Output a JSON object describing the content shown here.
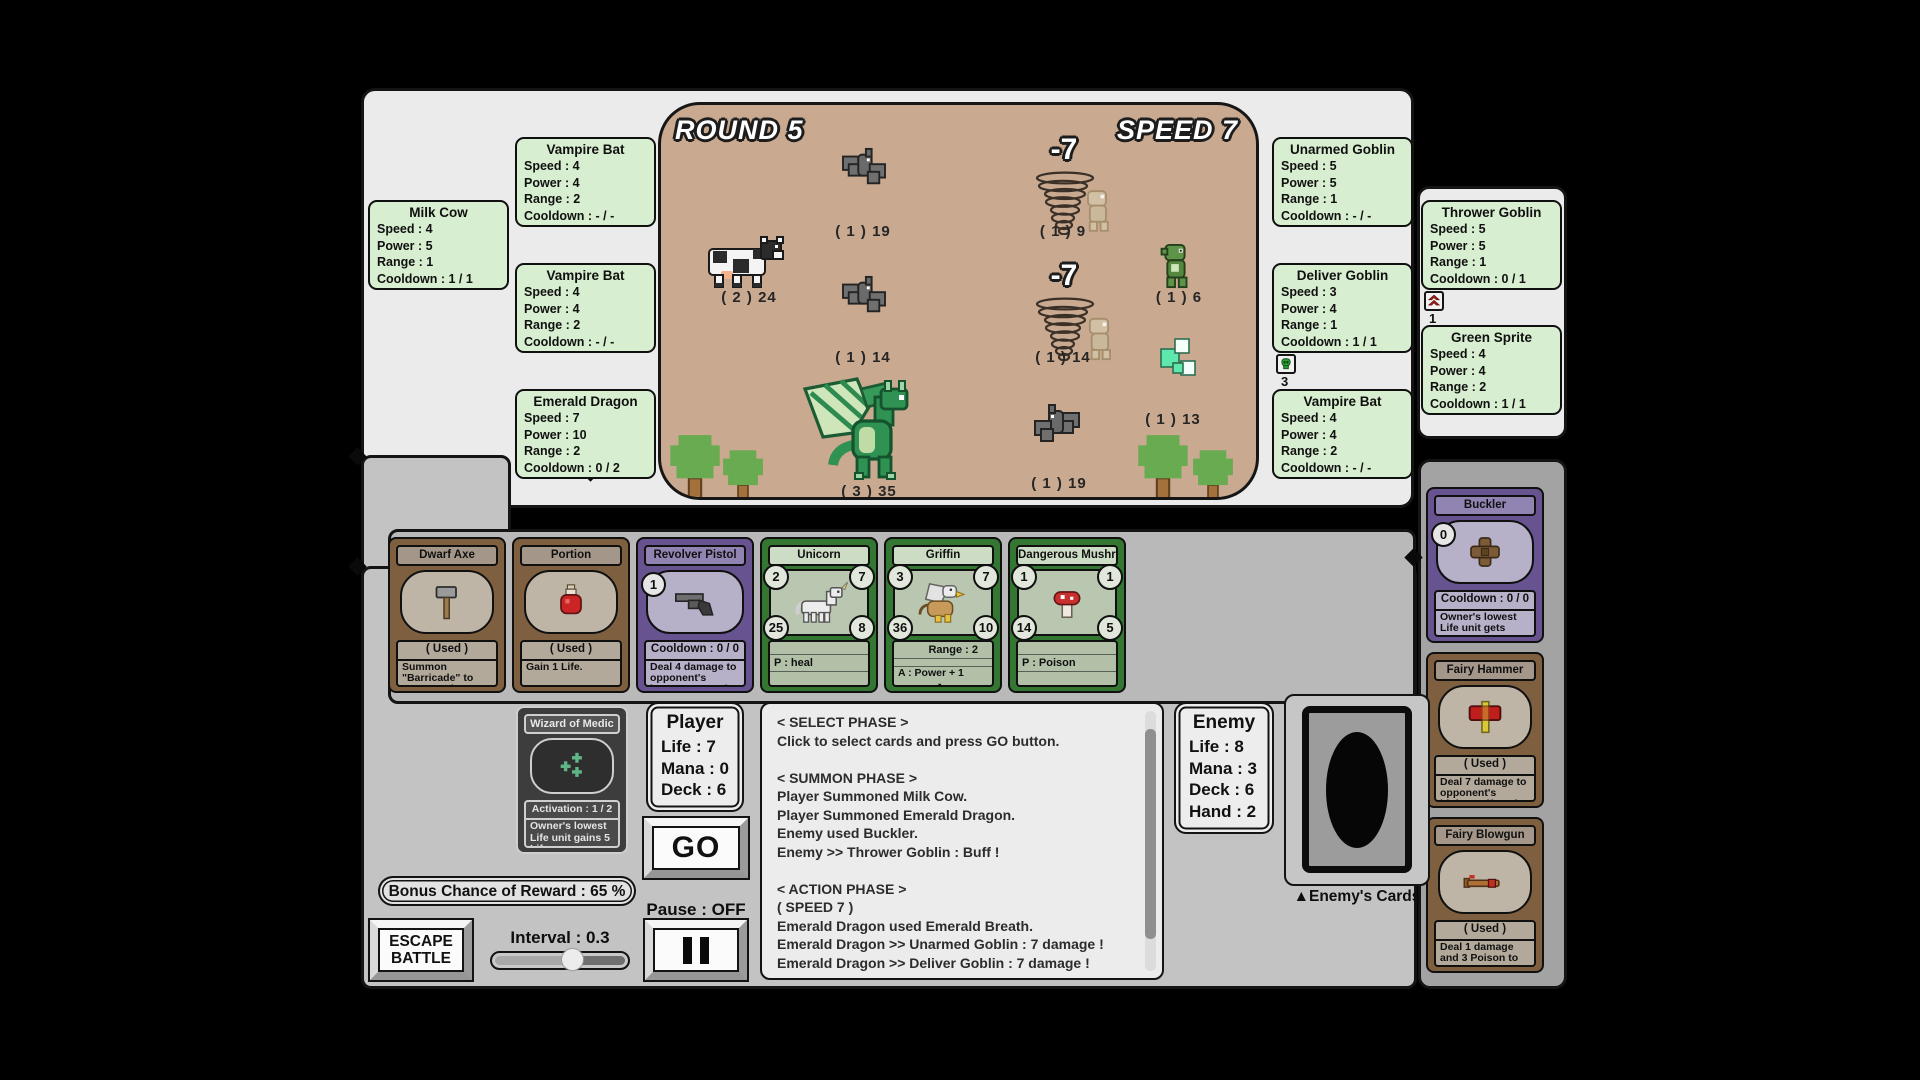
{
  "colors": {
    "background": "#000000",
    "panel_light": "#ebebeb",
    "panel_mid": "#c3c3c3",
    "panel_hand": "#b9b9b9",
    "panel_dark": "#a3a3a3",
    "field_tan": "#c9a98f",
    "tooltip_green": "#d8eed0",
    "card_brown": "#7e6040",
    "card_purple": "#665390",
    "card_green": "#337733",
    "card_dark": "#3d3d3d"
  },
  "icons": {
    "dwarf_axe": "axe-icon",
    "portion": "potion-icon",
    "revolver_pistol": "revolver-icon",
    "unicorn": "unicorn-icon",
    "griffin": "griffin-icon",
    "dangerous_mushroom": "mushroom-icon",
    "buckler": "buckler-icon",
    "fairy_hammer": "hammer-icon",
    "fairy_blowgun": "blowgun-icon",
    "wizard": "medic-plus-icon",
    "poison": "poison-skull-icon",
    "buff": "buff-chevrons-icon"
  },
  "field": {
    "round_label": "ROUND 5",
    "speed_label": "SPEED 7",
    "damage_popup_1": "-7",
    "damage_popup_2": "-7",
    "labels": {
      "milk_cow": "( 2 )  24",
      "vampire_bat_1": "( 1 )  19",
      "vampire_bat_2": "( 1 )  14",
      "emerald_dragon": "( 3 )  35",
      "tornado_goblin_1": "( 1 )  9",
      "tornado_goblin_2": "( 1 )  14",
      "green_goblin": "( 1 )  6",
      "green_sprite": "( 1 )  13",
      "enemy_bat": "( 1 )  19"
    }
  },
  "tooltips": {
    "milk_cow": {
      "title": "Milk Cow",
      "speed": "Speed :  4",
      "power": "Power :  5",
      "range": "Range :  1",
      "cooldown": "Cooldown :  1 / 1"
    },
    "vampire_bat_1": {
      "title": "Vampire Bat",
      "speed": "Speed :  4",
      "power": "Power :  4",
      "range": "Range :  2",
      "cooldown": "Cooldown :  - / -"
    },
    "vampire_bat_2": {
      "title": "Vampire Bat",
      "speed": "Speed :  4",
      "power": "Power :  4",
      "range": "Range :  2",
      "cooldown": "Cooldown :  - / -"
    },
    "emerald_dragon": {
      "title": "Emerald Dragon",
      "speed": "Speed :  7",
      "power": "Power :  10",
      "range": "Range :  2",
      "cooldown": "Cooldown :  0 / 2"
    },
    "unarmed_goblin": {
      "title": "Unarmed Goblin",
      "speed": "Speed :  5",
      "power": "Power :  5",
      "range": "Range :  1",
      "cooldown": "Cooldown :  - / -"
    },
    "thrower_goblin": {
      "title": "Thrower Goblin",
      "speed": "Speed :  5",
      "power": "Power :  5",
      "range": "Range :  1",
      "cooldown": "Cooldown :  0 / 1",
      "buff_count": "1"
    },
    "deliver_goblin": {
      "title": "Deliver Goblin",
      "speed": "Speed :  3",
      "power": "Power :  4",
      "range": "Range :  1",
      "cooldown": "Cooldown :  1 / 1",
      "poison_count": "3"
    },
    "green_sprite": {
      "title": "Green Sprite",
      "speed": "Speed :  4",
      "power": "Power :  4",
      "range": "Range :  2",
      "cooldown": "Cooldown :  1 / 1"
    },
    "vampire_bat_3": {
      "title": "Vampire Bat",
      "speed": "Speed :  4",
      "power": "Power :  4",
      "range": "Range :  2",
      "cooldown": "Cooldown :  - / -"
    }
  },
  "hand": {
    "dwarf_axe": {
      "title": "Dwarf Axe",
      "status": "( Used )",
      "desc": "Summon \"Barricade\" to owner's Line 1."
    },
    "portion": {
      "title": "Portion",
      "status": "( Used )",
      "desc": "Gain 1 Life."
    },
    "revolver_pistol": {
      "title": "Revolver Pistol",
      "cost": "1",
      "status": "Cooldown :  0 / 0",
      "desc": "Deal 4 damage to opponent's lowest Cost unit and dra..."
    },
    "unicorn": {
      "title": "Unicorn",
      "tl": "2",
      "tr": "7",
      "bl": "25",
      "br": "8",
      "row": "P :  heal"
    },
    "griffin": {
      "title": "Griffin",
      "tl": "3",
      "tr": "7",
      "bl": "36",
      "br": "10",
      "row1": "Range :  2",
      "row2": "A :  Power + 1",
      "row3": "-"
    },
    "dangerous_mushroom": {
      "title": "Dangerous Mushro...",
      "tl": "1",
      "tr": "1",
      "bl": "14",
      "br": "5",
      "row": "P :  Poison"
    }
  },
  "enemy_used": {
    "buckler": {
      "title": "Buckler",
      "cost": "0",
      "status": "Cooldown :  0 / 0",
      "desc": "Owner's lowest Life unit gets \"Prevents 2 damage from..."
    },
    "fairy_hammer": {
      "title": "Fairy Hammer",
      "status": "( Used )",
      "desc": "Deal 7 damage to opponent's highest Life unit."
    },
    "fairy_blowgun": {
      "title": "Fairy Blowgun",
      "status": "( Used )",
      "desc": "Deal 1 damage and 3 Poison to opponent's highes..."
    }
  },
  "wizard": {
    "title": "Wizard of Medic",
    "status": "Activation :  1 / 2",
    "desc": "Owner's lowest Life unit gains 5 Life."
  },
  "player": {
    "title": "Player",
    "life": "Life :  7",
    "mana": "Mana :  0",
    "deck": "Deck :  6",
    "go_label": "GO"
  },
  "enemy": {
    "title": "Enemy",
    "life": "Life :  8",
    "mana": "Mana :  3",
    "deck": "Deck :  6",
    "hand": "Hand :  2",
    "cards_label": "▲Enemy's Cards"
  },
  "log": {
    "lines": [
      "< SELECT PHASE >",
      "Click to select cards and press GO button.",
      "",
      "< SUMMON PHASE >",
      "Player Summoned Milk Cow.",
      "Player Summoned Emerald Dragon.",
      "Enemy used Buckler.",
      "Enemy >> Thrower Goblin : Buff !",
      "",
      "< ACTION PHASE >",
      "( SPEED 7 )",
      "Emerald Dragon used Emerald Breath.",
      "Emerald Dragon >> Unarmed Goblin : 7 damage !",
      "Emerald Dragon >> Deliver Goblin : 7 damage !"
    ]
  },
  "controls": {
    "bonus_label": "Bonus Chance of Reward :  65 %",
    "escape_line1": "ESCAPE",
    "escape_line2": "BATTLE",
    "interval_label": "Interval :  0.3",
    "pause_label": "Pause :  OFF"
  }
}
